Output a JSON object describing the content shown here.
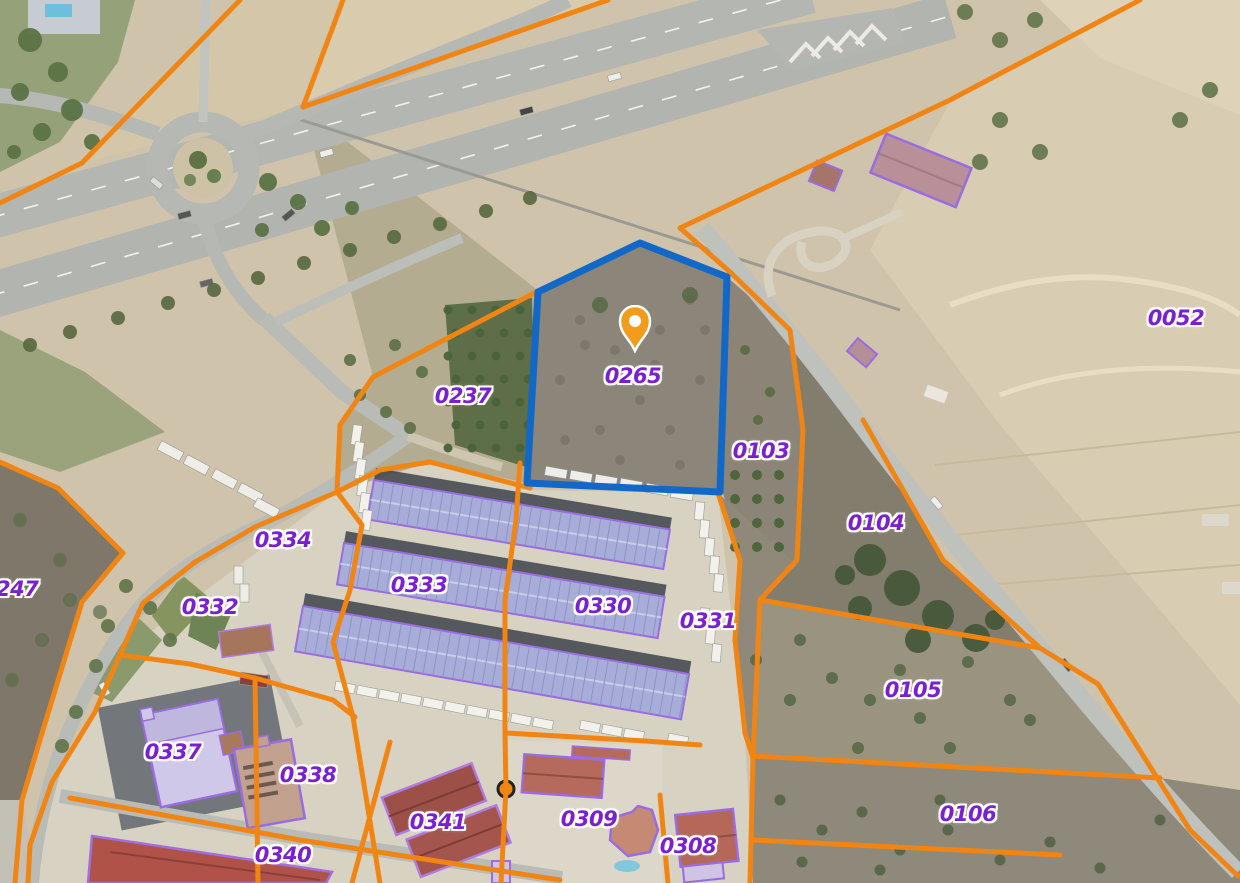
{
  "map": {
    "view": "cadastral-aerial-orthophoto",
    "selected_parcel": "0265",
    "marker": {
      "type": "location-pin",
      "parcel": "0265",
      "x": 635,
      "y": 353
    },
    "parcels": [
      {
        "id": "0052",
        "x": 1176,
        "y": 318
      },
      {
        "id": "0237",
        "x": 463,
        "y": 396
      },
      {
        "id": "0265",
        "x": 633,
        "y": 376,
        "selected": true
      },
      {
        "id": "0103",
        "x": 761,
        "y": 451
      },
      {
        "id": "0104",
        "x": 876,
        "y": 523
      },
      {
        "id": "0334",
        "x": 283,
        "y": 540
      },
      {
        "id": "0332",
        "x": 210,
        "y": 607
      },
      {
        "id": "0333",
        "x": 419,
        "y": 585
      },
      {
        "id": "0330",
        "x": 603,
        "y": 606
      },
      {
        "id": "0331",
        "x": 708,
        "y": 621
      },
      {
        "id": "247",
        "x": -4,
        "y": 589,
        "edge": true
      },
      {
        "id": "0105",
        "x": 913,
        "y": 690
      },
      {
        "id": "0337",
        "x": 173,
        "y": 752
      },
      {
        "id": "0338",
        "x": 308,
        "y": 775
      },
      {
        "id": "0341",
        "x": 438,
        "y": 822
      },
      {
        "id": "0340",
        "x": 283,
        "y": 855
      },
      {
        "id": "0309",
        "x": 589,
        "y": 819
      },
      {
        "id": "0308",
        "x": 688,
        "y": 846
      },
      {
        "id": "0106",
        "x": 968,
        "y": 814
      }
    ],
    "colors": {
      "parcel_boundary": "#f08514",
      "selected_parcel_boundary": "#1268c6",
      "parcel_label": "#7b1fd3",
      "building_outline": "#9a6ce0",
      "marker_fill": "#f39c1b"
    }
  }
}
